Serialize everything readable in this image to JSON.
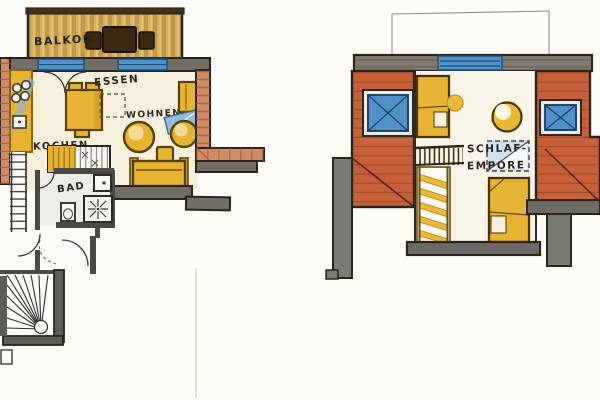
{
  "labels": {
    "ground_floor": {
      "balcony": "BALKON",
      "dining": "ESSEN",
      "kitchen": "KOCHEN",
      "living": "WOHNEN",
      "bathroom": "BAD"
    },
    "upper_floor": {
      "sleeping_loft_line1": "SCHLAF-",
      "sleeping_loft_line2": "EMPORE"
    }
  },
  "colors": {
    "paper": "#fdfcf7",
    "ink": "#2b241c",
    "wall_gray": "#716d67",
    "wall_dark": "#2b241c",
    "wall_dark_gray": "#4a4a45",
    "wood_base": "#d6b061",
    "wood_stripe": "#c09a45",
    "dark_wood": "#3c2912",
    "brick": "#d08c66",
    "brick_joint": "#a05a35",
    "roof_orange": "#c6613a",
    "roof_plank": "#9e4a26",
    "furniture_yellow": "#e6b432",
    "furniture_outline": "#55400e",
    "window_blue": "#4e92c8",
    "window_blue_dark": "#1d4c78",
    "floor_cream": "#f6efdc",
    "bath_floor": "#edeee8",
    "glass_light_blue": "#8ab6da"
  }
}
